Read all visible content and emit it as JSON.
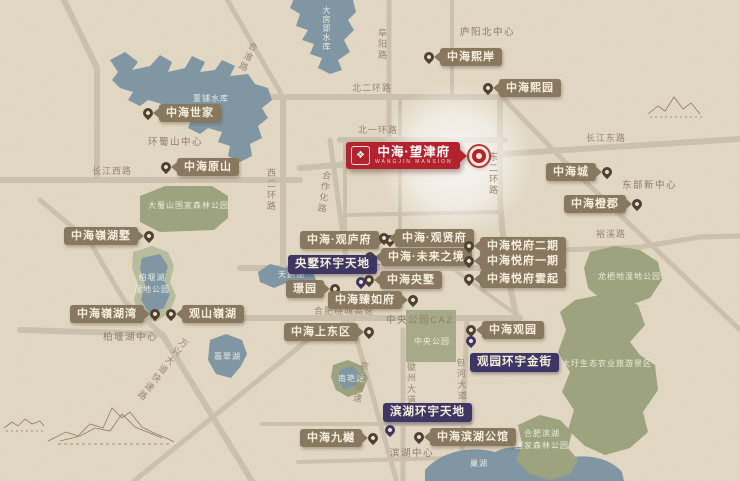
{
  "banner": {
    "name": "中海·望津府",
    "subtitle": "WANGJIN MANSION",
    "logo_icon": "china-overseas-rosette-icon",
    "logo_glyph": "❖"
  },
  "colors": {
    "background": "#e2d8c4",
    "water": "#7f96a3",
    "park": "#9ba37d",
    "park_light": "#a7aa88",
    "wetland_ring": "#b7bd9e",
    "road": "#cbc1ae",
    "chip_brown": "#897860",
    "chip_purple": "#3e3663",
    "banner_red": "#b2232e",
    "muted_text": "#97886f"
  },
  "property_markers": [
    {
      "text": "中海世家",
      "x": 143,
      "y": 104,
      "side": "left"
    },
    {
      "text": "中海原山",
      "x": 161,
      "y": 158,
      "side": "left"
    },
    {
      "text": "中海嶺湖墅",
      "x": 64,
      "y": 227,
      "side": "right"
    },
    {
      "text": "中海嶺湖湾",
      "x": 70,
      "y": 305,
      "side": "right"
    },
    {
      "text": "观山嶺湖",
      "x": 166,
      "y": 305,
      "side": "left"
    },
    {
      "text": "中海熙岸",
      "x": 424,
      "y": 48,
      "side": "left"
    },
    {
      "text": "中海熙园",
      "x": 483,
      "y": 79,
      "side": "left"
    },
    {
      "text": "中海城",
      "x": 546,
      "y": 163,
      "side": "right"
    },
    {
      "text": "中海橙郡",
      "x": 564,
      "y": 195,
      "side": "right"
    },
    {
      "text": "中海·观庐府",
      "x": 300,
      "y": 231,
      "side": "right"
    },
    {
      "text": "中海·观贤府",
      "x": 379,
      "y": 229,
      "side": "left"
    },
    {
      "text": "中海·未来之境",
      "x": 365,
      "y": 248,
      "side": "left"
    },
    {
      "text": "中海央墅",
      "x": 364,
      "y": 271,
      "side": "left"
    },
    {
      "text": "璟园",
      "x": 286,
      "y": 280,
      "side": "right"
    },
    {
      "text": "中海臻如府",
      "x": 328,
      "y": 291,
      "side": "right"
    },
    {
      "text": "中海上东区",
      "x": 284,
      "y": 323,
      "side": "right"
    },
    {
      "text": "中海悦府二期",
      "x": 464,
      "y": 237,
      "side": "left"
    },
    {
      "text": "中海悦府一期",
      "x": 464,
      "y": 252,
      "side": "left"
    },
    {
      "text": "中海悦府雲起",
      "x": 464,
      "y": 270,
      "side": "left"
    },
    {
      "text": "中海观园",
      "x": 466,
      "y": 321,
      "side": "left"
    },
    {
      "text": "中海九樾",
      "x": 300,
      "y": 429,
      "side": "right"
    },
    {
      "text": "中海滨湖公馆",
      "x": 414,
      "y": 428,
      "side": "left"
    }
  ],
  "commercial_markers": [
    {
      "text": "央墅环宇天地",
      "chip": {
        "x": 288,
        "y": 255
      },
      "pin": {
        "x": 356,
        "y": 277
      }
    },
    {
      "text": "观园环宇金街",
      "chip": {
        "x": 470,
        "y": 353
      },
      "pin": {
        "x": 466,
        "y": 336
      }
    },
    {
      "text": "滨湖环宇天地",
      "chip": {
        "x": 383,
        "y": 403
      },
      "pin": {
        "x": 385,
        "y": 425
      }
    }
  ],
  "road_labels": [
    {
      "text": "合淮路",
      "x": 250,
      "y": 40,
      "orient": "v",
      "rot": 25
    },
    {
      "text": "阜阳路",
      "x": 377,
      "y": 28,
      "orient": "v",
      "rot": 0
    },
    {
      "text": "北二环路",
      "x": 352,
      "y": 84,
      "orient": "h",
      "rot": 0
    },
    {
      "text": "北一环路",
      "x": 358,
      "y": 126,
      "orient": "h",
      "rot": 0
    },
    {
      "text": "西二环路",
      "x": 266,
      "y": 168,
      "orient": "v",
      "rot": 0
    },
    {
      "text": "合作化路",
      "x": 322,
      "y": 170,
      "orient": "v",
      "rot": 8
    },
    {
      "text": "长江西路",
      "x": 92,
      "y": 167,
      "orient": "h",
      "rot": 0
    },
    {
      "text": "东二环路",
      "x": 488,
      "y": 152,
      "orient": "v",
      "rot": 0
    },
    {
      "text": "长江东路",
      "x": 586,
      "y": 134,
      "orient": "h",
      "rot": 0
    },
    {
      "text": "南二环路",
      "x": 362,
      "y": 258,
      "orient": "h",
      "rot": 0
    },
    {
      "text": "合肥绕城高速",
      "x": 314,
      "y": 307,
      "orient": "h",
      "rot": 0
    },
    {
      "text": "裕溪路",
      "x": 596,
      "y": 230,
      "orient": "h",
      "rot": 0
    },
    {
      "text": "京台高速",
      "x": 360,
      "y": 360,
      "orient": "v",
      "rot": 12
    },
    {
      "text": "徽州大道",
      "x": 406,
      "y": 362,
      "orient": "v",
      "rot": 0
    },
    {
      "text": "包河大道",
      "x": 455,
      "y": 358,
      "orient": "v",
      "rot": -3
    },
    {
      "text": "万兴大道快速路",
      "x": 182,
      "y": 336,
      "orient": "v",
      "rot": 38
    }
  ],
  "district_labels": [
    {
      "text": "环蜀山中心",
      "x": 148,
      "y": 138
    },
    {
      "text": "庐阳北中心",
      "x": 460,
      "y": 28
    },
    {
      "text": "东部新中心",
      "x": 622,
      "y": 181
    },
    {
      "text": "中央公园CAZ",
      "x": 386,
      "y": 316
    },
    {
      "text": "柏堰湖中心",
      "x": 103,
      "y": 333
    },
    {
      "text": "滨湖中心",
      "x": 390,
      "y": 449
    }
  ],
  "water_labels": [
    {
      "text": "董铺水库",
      "x": 193,
      "y": 93,
      "orient": "h"
    },
    {
      "text": "大房郢水库",
      "x": 320,
      "y": 6,
      "orient": "v"
    },
    {
      "text": "天鹅湖",
      "x": 278,
      "y": 269,
      "orient": "h"
    },
    {
      "text": "柏堰湖\n湿地公园",
      "x": 134,
      "y": 272,
      "orient": "h"
    },
    {
      "text": "南艳湖",
      "x": 338,
      "y": 373,
      "orient": "h"
    },
    {
      "text": "翡翠湖",
      "x": 214,
      "y": 351,
      "orient": "h"
    },
    {
      "text": "巢湖",
      "x": 470,
      "y": 458,
      "orient": "h"
    }
  ],
  "park_labels": [
    {
      "text": "大蜀山国家森林公园",
      "x": 148,
      "y": 200
    },
    {
      "text": "龙栖地湿地公园",
      "x": 598,
      "y": 271
    },
    {
      "text": "大圩生态农业旅游景区",
      "x": 562,
      "y": 358
    },
    {
      "text": "合肥滨湖\n国家森林公园",
      "x": 515,
      "y": 428
    },
    {
      "text": "中央公园",
      "x": 414,
      "y": 336
    }
  ]
}
